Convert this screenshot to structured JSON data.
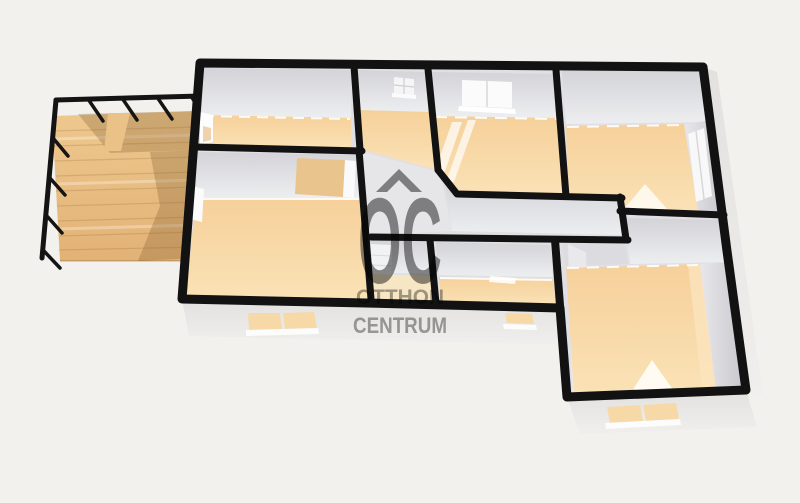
{
  "watermark": {
    "monogram": "OC",
    "brand_line1": "OTTHON",
    "brand_line2": "CENTRUM",
    "house_icon": "house-roof-chevron"
  },
  "palette": {
    "background": "#f2f1ed",
    "walls": "#121212",
    "floor": "#f8d7a2",
    "floor_light": "#fbe4bd",
    "wall_face_dark": "#d3d3d8",
    "wall_face_light": "#edeef0",
    "interior_base": "#e0e0e4",
    "exterior_skirt": "#e9e8e6",
    "window_glass": "#f6d9a6",
    "window_frame": "#fcfcfc",
    "terrace_wood": "#e9c18a",
    "terrace_wood_shadow": "#c6975d",
    "watermark_gray": "#8c8c8c",
    "watermark_text_gray": "#a3a3a3"
  }
}
